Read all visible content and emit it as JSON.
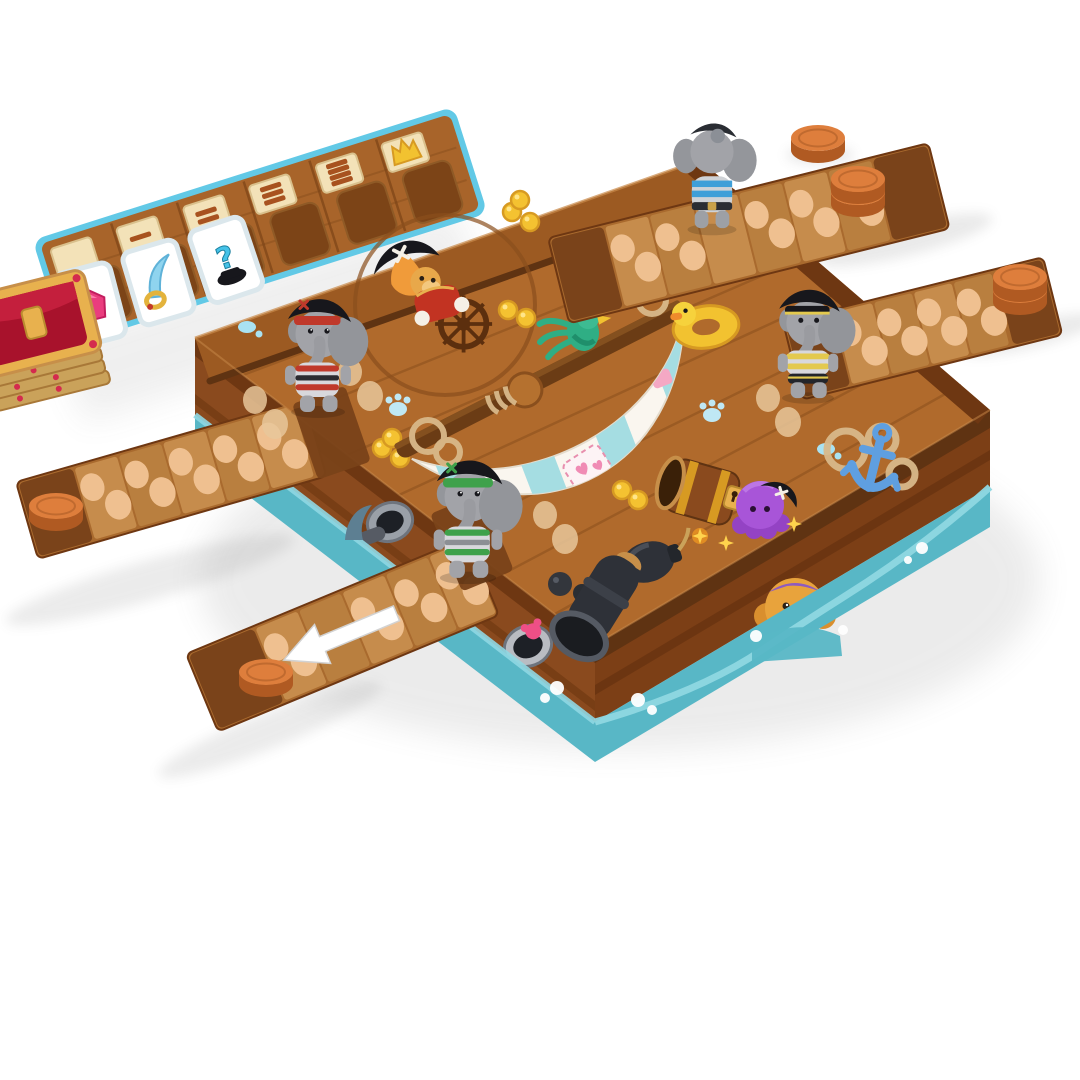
{
  "meta": {
    "scene": "3D product render of a pirate-ship board game on a white background",
    "background": "#ffffff"
  },
  "colors": {
    "deck_wood": "#b06a2c",
    "deck_wood_dark": "#9c5a22",
    "plank_line": "#8a4f1d",
    "railing": "#5f3312",
    "plank_wood": "#a96a2e",
    "plank_space": "#c68c4c",
    "plank_space_alt": "#b97f3f",
    "plank_end": "#7a431a",
    "footprint": "#efc090",
    "hull_wood": "#8a4a1e",
    "hull_trim": "#6e3712",
    "water": "#58b7c6",
    "water_light": "#8fd7e2",
    "coin_top": "#de7e3c",
    "coin_side": "#b05a22",
    "gold": "#f4c231",
    "tracker_border": "#62c9e6",
    "tracker_wood": "#a8642a",
    "tracker_tile": "#f3e2b8",
    "card_white": "#ffffff",
    "gem_pink": "#ea3d7e",
    "cutlass_blue": "#8fd4ef",
    "crown_gold": "#f2c230",
    "elephant_gray": "#a2a3a8",
    "accent_blue": "#3f9fd8",
    "accent_yellow": "#e3c94e",
    "accent_red": "#c0392b",
    "accent_green": "#3fa14b",
    "hat_black": "#17171c",
    "captain_red": "#c23322",
    "sail_white": "#faf6ef",
    "sail_stripe": "#a5dde2",
    "parrot_green": "#2fae84",
    "octopus_purple": "#a855d8",
    "anchor_blue": "#5f9fe0",
    "monkey_gold": "#e8a33c",
    "cannon_dark": "#2e3138"
  },
  "tracker": {
    "description": "Angled wooden progress strip with light-blue border, 6 columns: cream tile plus empty dark card slot each",
    "slots": [
      {
        "tile": "blank"
      },
      {
        "tile": "coin-bars-1",
        "bars": 1
      },
      {
        "tile": "coin-bars-2",
        "bars": 2
      },
      {
        "tile": "coin-bars-3",
        "bars": 3
      },
      {
        "tile": "coin-bars-4",
        "bars": 4
      },
      {
        "tile": "crown"
      }
    ],
    "cards": [
      {
        "icon": "pink-gem"
      },
      {
        "icon": "cutlass"
      },
      {
        "icon": "mystery",
        "glyph": "?"
      }
    ]
  },
  "treasure_stack": {
    "description": "Stack of gold-rimmed treasure tiles with red velvet chest art, clipped at left edge"
  },
  "board": {
    "description": "Square pirate-ship deck box with wooden hull sides sitting in teal water",
    "printed_art": [
      "captain-at-ships-wheel",
      "engraved-circle",
      "mast-with-striped-sail",
      "parrot-with-pirate-hat",
      "rubber-duck-ring",
      "rope-coils",
      "blue-anchor",
      "treasure-barrel",
      "purple-octopus-with-hat",
      "bomb-with-lit-fuse",
      "cannonballs",
      "corner-cannon",
      "gold-coin-clusters",
      "blue-paw-prints",
      "water-droplets",
      "porthole-cannons",
      "porthole-crab",
      "golden-monkey-figurehead",
      "shark-fin"
    ]
  },
  "planks": [
    {
      "side": "top",
      "spaces": 6,
      "note": "elephant with blue stripes walking, coins at far end"
    },
    {
      "side": "right",
      "spaces": 4,
      "note": "coin stack on far end"
    },
    {
      "side": "left",
      "spaces": 5,
      "note": "single coin on far end"
    },
    {
      "side": "bottom",
      "spaces": 5,
      "note": "white arrow pointing outward, single coin on far end"
    }
  ],
  "pieces": {
    "elephants": [
      {
        "position": "top-plank",
        "accent": "blue",
        "view": "back"
      },
      {
        "position": "right-plank-start",
        "accent": "yellow",
        "view": "front"
      },
      {
        "position": "left-deck-edge",
        "accent": "red",
        "view": "front"
      },
      {
        "position": "bottom-deck-edge",
        "accent": "green",
        "view": "front"
      }
    ],
    "coins": [
      {
        "location": "table-top-right",
        "count": 1
      },
      {
        "location": "top-plank-end",
        "count": 2
      },
      {
        "location": "right-plank-end",
        "count": 2
      },
      {
        "location": "left-plank-end",
        "count": 1
      },
      {
        "location": "bottom-plank-end",
        "count": 1
      }
    ]
  }
}
